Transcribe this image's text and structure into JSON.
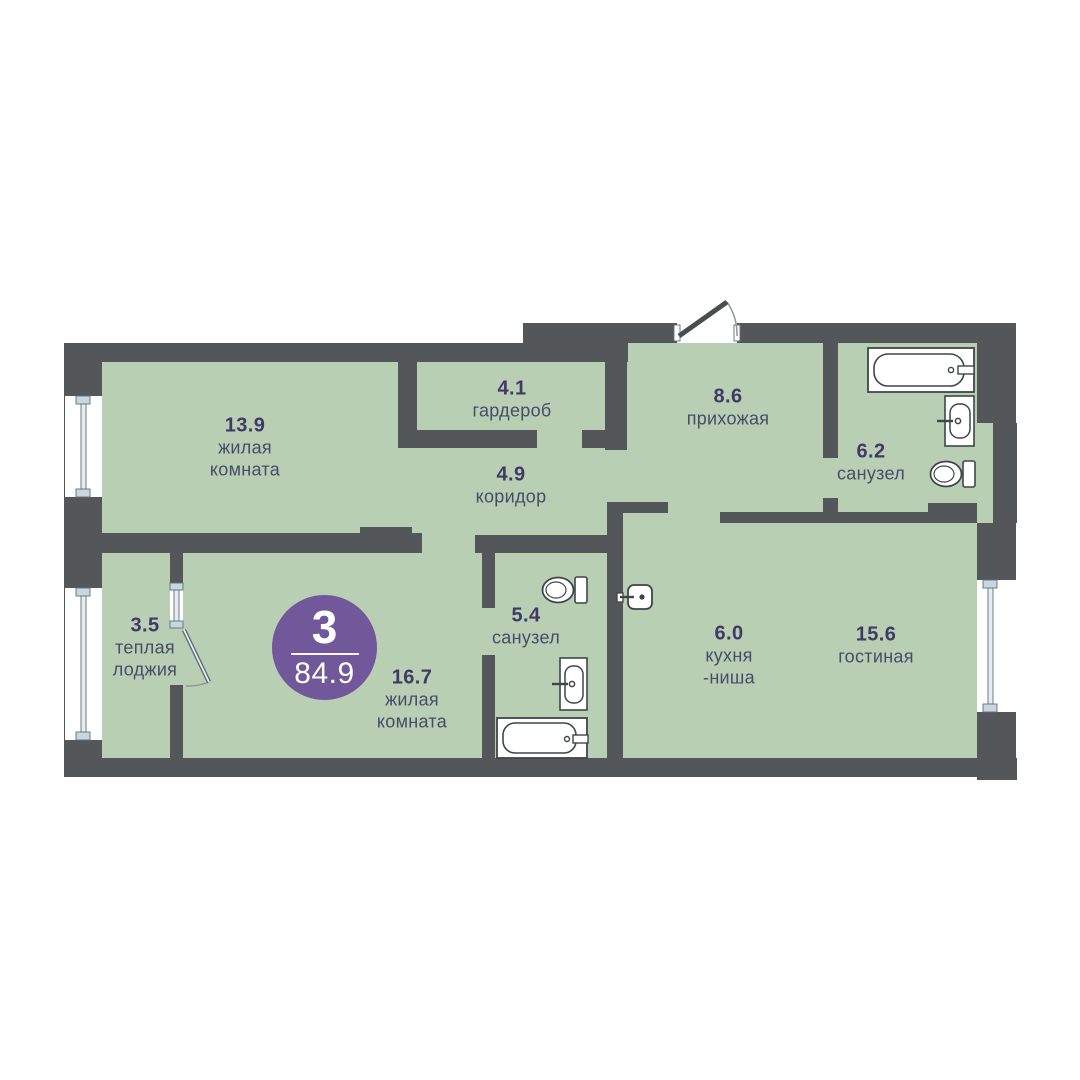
{
  "plan": {
    "title": "3-комнатная квартира",
    "badge": {
      "rooms_count": "3",
      "total_area": "84.9"
    },
    "rooms": [
      {
        "id": "living-room-1",
        "area": "13.9",
        "name": "жилая\nкомната"
      },
      {
        "id": "wardrobe",
        "area": "4.1",
        "name": "гардероб"
      },
      {
        "id": "corridor",
        "area": "4.9",
        "name": "коридор"
      },
      {
        "id": "hallway",
        "area": "8.6",
        "name": "прихожая"
      },
      {
        "id": "bathroom-1",
        "area": "6.2",
        "name": "санузел"
      },
      {
        "id": "bathroom-2",
        "area": "5.4",
        "name": "санузел"
      },
      {
        "id": "loggia",
        "area": "3.5",
        "name": "теплая\nлоджия"
      },
      {
        "id": "living-room-2",
        "area": "16.7",
        "name": "жилая\nкомната"
      },
      {
        "id": "kitchen-niche",
        "area": "6.0",
        "name": "кухня\n-ниша"
      },
      {
        "id": "living-room-3",
        "area": "15.6",
        "name": "гостиная"
      }
    ],
    "icons": [
      "bathtub-icon",
      "sink-icon",
      "toilet-icon",
      "kitchen-sink-icon",
      "window-icon",
      "entrance-door-icon",
      "loggia-door-icon"
    ],
    "colors": {
      "wall": "#53575a",
      "room_fill": "#b8cfb4",
      "badge": "#71589b",
      "area_text": "#3f3a66",
      "name_text": "#474c68",
      "fixture_stroke": "#3f4649",
      "window_frame": "#5f707a"
    }
  }
}
